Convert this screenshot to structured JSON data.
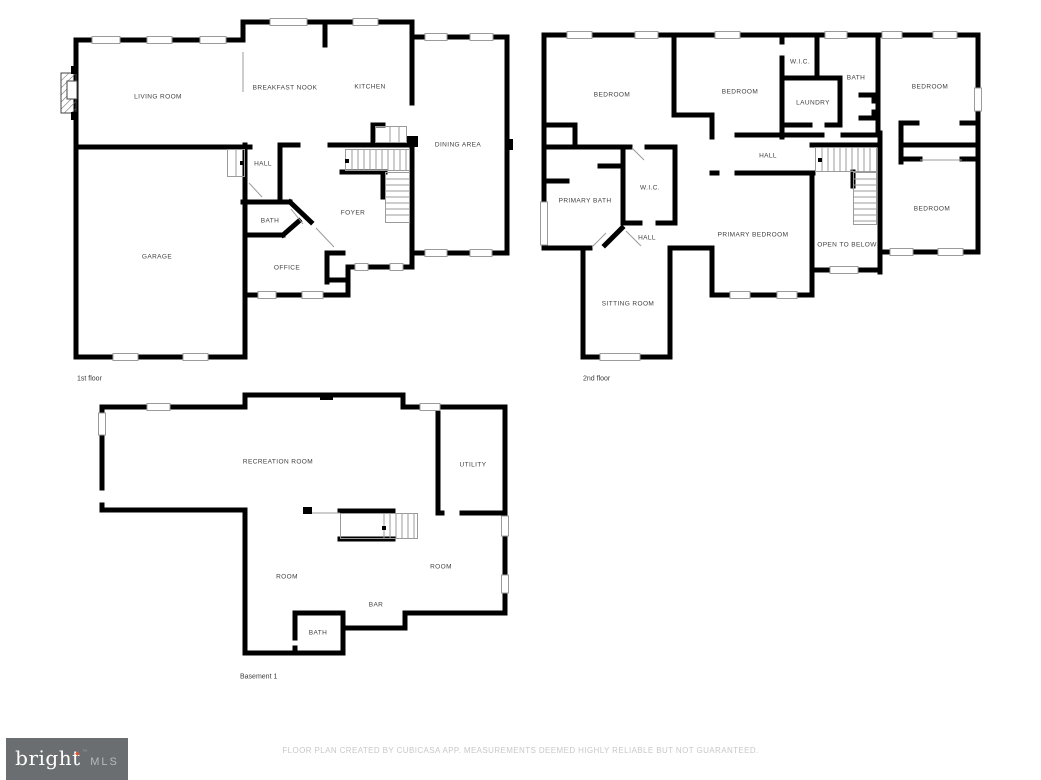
{
  "page": {
    "disclaimer": "FLOOR PLAN CREATED BY CUBICASA APP. MEASUREMENTS DEEMED HIGHLY RELIABLE BUT NOT GUARANTEED."
  },
  "branding": {
    "name": "bright",
    "suffix": "MLS",
    "trademark": "™",
    "star_glyph": "✦",
    "star_icon": "four-pointed-star",
    "colors": {
      "background": "#6a6e71",
      "name": "#ffffff",
      "suffix": "#b7babc",
      "star": "#e0552d"
    }
  },
  "drawing": {
    "wall_color": "#000000",
    "thin_line_color": "#9b9b9b",
    "room_label_color": "#3f3f3f",
    "disclaimer_color": "#c8c8c8"
  },
  "floors": [
    {
      "label": "1st floor",
      "rooms": [
        {
          "label": "LIVING ROOM"
        },
        {
          "label": "BREAKFAST NOOK"
        },
        {
          "label": "KITCHEN"
        },
        {
          "label": "DINING AREA"
        },
        {
          "label": "HALL"
        },
        {
          "label": "BATH"
        },
        {
          "label": "FOYER"
        },
        {
          "label": "GARAGE"
        },
        {
          "label": "OFFICE"
        }
      ]
    },
    {
      "label": "2nd floor",
      "rooms": [
        {
          "label": "BEDROOM"
        },
        {
          "label": "BEDROOM"
        },
        {
          "label": "W.I.C."
        },
        {
          "label": "LAUNDRY"
        },
        {
          "label": "BATH"
        },
        {
          "label": "BEDROOM"
        },
        {
          "label": "HALL"
        },
        {
          "label": "PRIMARY BATH"
        },
        {
          "label": "W.I.C."
        },
        {
          "label": "HALL"
        },
        {
          "label": "PRIMARY BEDROOM"
        },
        {
          "label": "OPEN TO BELOW"
        },
        {
          "label": "BEDROOM"
        },
        {
          "label": "SITTING ROOM"
        }
      ]
    },
    {
      "label": "Basement 1",
      "rooms": [
        {
          "label": "RECREATION ROOM"
        },
        {
          "label": "UTILITY"
        },
        {
          "label": "ROOM"
        },
        {
          "label": "ROOM"
        },
        {
          "label": "BAR"
        },
        {
          "label": "BATH"
        }
      ]
    }
  ]
}
